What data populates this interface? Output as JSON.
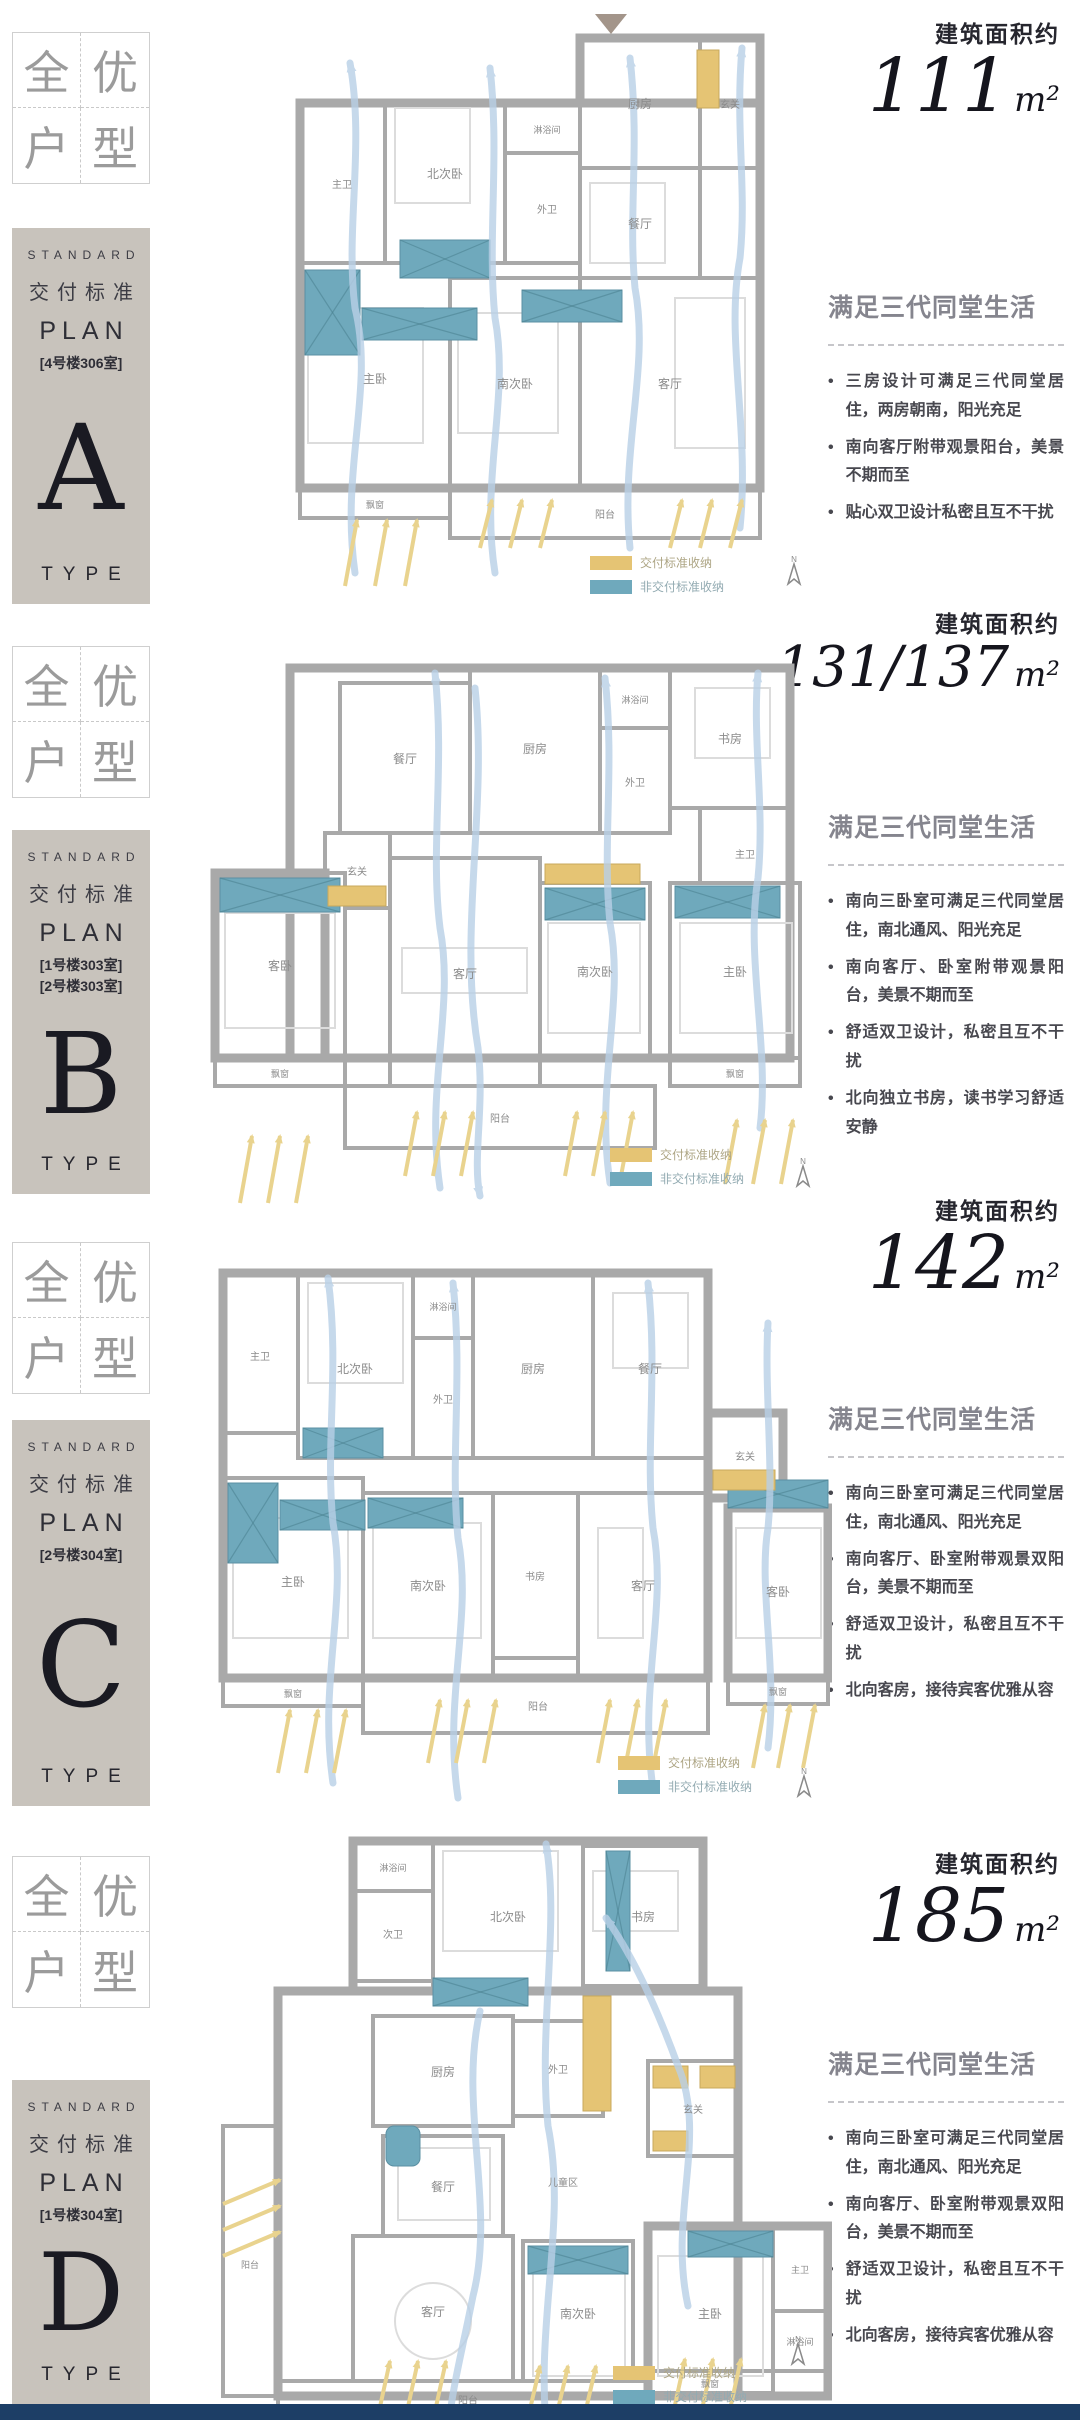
{
  "ui": {
    "bullet": "•"
  },
  "quad": {
    "c1": "全",
    "c2": "优",
    "c3": "户",
    "c4": "型"
  },
  "common": {
    "standard": "STANDARD",
    "delivery": "交付标准",
    "plan": "PLAN",
    "type": "TYPE"
  },
  "legend": {
    "standard_label": "交付标准收纳",
    "nonstandard_label": "非交付标准收纳",
    "standard_color": "#e5c474",
    "nonstandard_color": "#6fa9bc"
  },
  "compass": {
    "label": "N"
  },
  "colors": {
    "footer": "#1d3e66",
    "card_bg": "#c8c3bc",
    "flow_arrow": "#b9d0e7",
    "sun_arrow": "#e9d38e"
  },
  "sections": [
    {
      "letter": "A",
      "card_notes": [
        "[4号楼306室]"
      ],
      "area": {
        "label": "建筑面积约",
        "value": "111",
        "unit": "m²"
      },
      "headline": "满足三代同堂生活",
      "bullets": [
        "三房设计可满足三代同堂居住，两房朝南，阳光充足",
        "南向客厅附带观景阳台，美景不期而至",
        "贴心双卫设计私密且互不干扰"
      ],
      "plan": {
        "zhu_wei": "主卫",
        "bei_ci_wo": "北次卧",
        "lin_yu": "淋浴间",
        "wai_wei": "外卫",
        "chu_fang": "厨房",
        "xuan_guan": "玄关",
        "can_ting": "餐厅",
        "zhu_wo": "主卧",
        "nan_ci_wo": "南次卧",
        "ke_ting": "客厅",
        "yang_tai": "阳台",
        "piao_chuang": "飘窗"
      }
    },
    {
      "letter": "B",
      "card_notes": [
        "[1号楼303室]",
        "[2号楼303室]"
      ],
      "area": {
        "label": "建筑面积约",
        "value": "131/137",
        "unit": "m²"
      },
      "headline": "满足三代同堂生活",
      "bullets": [
        "南向三卧室可满足三代同堂居住，南北通风、阳光充足",
        "南向客厅、卧室附带观景阳台，美景不期而至",
        "舒适双卫设计，私密且互不干扰",
        "北向独立书房，读书学习舒适安静"
      ],
      "plan": {
        "can_ting": "餐厅",
        "chu_fang": "厨房",
        "lin_yu": "淋浴间",
        "wai_wei": "外卫",
        "shu_fang": "书房",
        "zhu_wei": "主卫",
        "xuan_guan": "玄关",
        "ke_wo": "客卧",
        "ke_ting": "客厅",
        "nan_ci_wo": "南次卧",
        "zhu_wo": "主卧",
        "yang_tai": "阳台",
        "piao_chuang": "飘窗"
      }
    },
    {
      "letter": "C",
      "card_notes": [
        "[2号楼304室]"
      ],
      "area": {
        "label": "建筑面积约",
        "value": "142",
        "unit": "m²"
      },
      "headline": "满足三代同堂生活",
      "bullets": [
        "南向三卧室可满足三代同堂居住，南北通风、阳光充足",
        "南向客厅、卧室附带观景双阳台，美景不期而至",
        "舒适双卫设计，私密且互不干扰",
        "北向客房，接待宾客优雅从容"
      ],
      "plan": {
        "zhu_wei": "主卫",
        "bei_ci_wo": "北次卧",
        "lin_yu": "淋浴间",
        "wai_wei": "外卫",
        "chu_fang": "厨房",
        "can_ting": "餐厅",
        "xuan_guan": "玄关",
        "zhu_wo": "主卧",
        "nan_ci_wo": "南次卧",
        "shu_fang": "书房",
        "ke_ting": "客厅",
        "ke_wo": "客卧",
        "yang_tai": "阳台",
        "piao_chuang": "飘窗"
      }
    },
    {
      "letter": "D",
      "card_notes": [
        "[1号楼304室]"
      ],
      "area": {
        "label": "建筑面积约",
        "value": "185",
        "unit": "m²"
      },
      "headline": "满足三代同堂生活",
      "bullets": [
        "南向三卧室可满足三代同堂居住，南北通风、阳光充足",
        "南向客厅、卧室附带观景双阳台，美景不期而至",
        "舒适双卫设计，私密且互不干扰",
        "北向客房，接待宾客优雅从容"
      ],
      "plan": {
        "lin_yu": "淋浴间",
        "ci_wei": "次卫",
        "bei_ci_wo": "北次卧",
        "shu_fang": "书房",
        "chu_fang": "厨房",
        "wai_wei": "外卫",
        "xuan_guan": "玄关",
        "can_ting": "餐厅",
        "er_tong_qu": "儿童区",
        "ke_ting": "客厅",
        "nan_ci_wo": "南次卧",
        "zhu_wo": "主卧",
        "zhu_wei": "主卫",
        "lin_yu2": "淋浴间",
        "yang_tai": "阳台",
        "yang_tai2": "阳台",
        "piao_chuang": "飘窗"
      }
    }
  ]
}
